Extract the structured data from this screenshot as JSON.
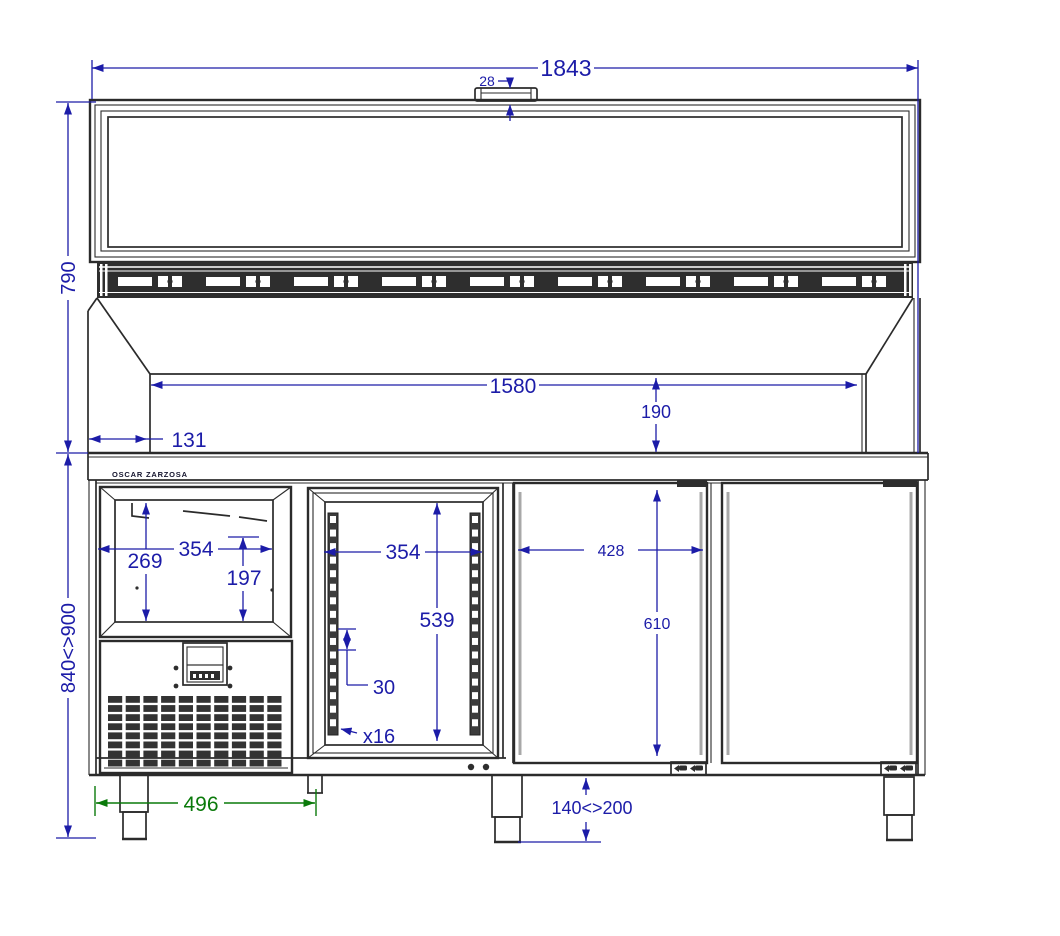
{
  "drawing": {
    "brand": "OSCAR ZARZOSA",
    "dimensions": {
      "overall_width": "1843",
      "handle_height": "28",
      "display_section_height": "790",
      "body_height_range": "840<>900",
      "well_width": "1580",
      "well_depth": "190",
      "left_offset": "131",
      "bin_width": "354",
      "bin_height": "269",
      "bin_inner_height": "197",
      "rack_width": "354",
      "rack_height": "539",
      "slot_pitch": "30",
      "slot_count": "x16",
      "door_width": "428",
      "door_height": "610",
      "foot_span": "496",
      "foot_height_range": "140<>200"
    },
    "colors": {
      "dimension_blue": "#1c1ca8",
      "dimension_green": "#0a7a0a",
      "line": "#2b2b2b"
    },
    "patterns": {
      "rail_slots": 16,
      "grille_rows": 8,
      "grille_cols": 10,
      "hinge_units": 9
    }
  }
}
